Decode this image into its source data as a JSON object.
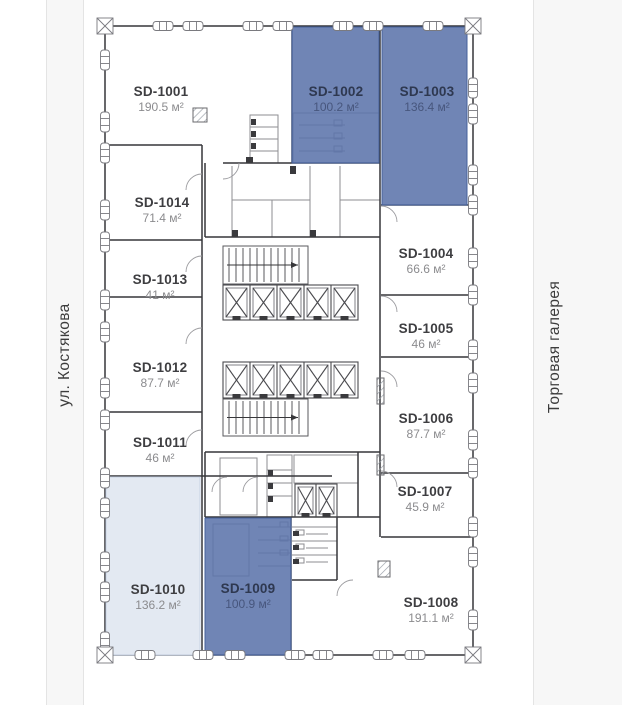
{
  "side_labels": {
    "left": "ул. Костякова",
    "right": "Торговая галерея"
  },
  "units": [
    {
      "id": "SD-1001",
      "name": "SD-1001",
      "area": "190.5 м²",
      "highlight": "none"
    },
    {
      "id": "SD-1002",
      "name": "SD-1002",
      "area": "100.2 м²",
      "highlight": "blue"
    },
    {
      "id": "SD-1003",
      "name": "SD-1003",
      "area": "136.4 м²",
      "highlight": "blue"
    },
    {
      "id": "SD-1004",
      "name": "SD-1004",
      "area": "66.6 м²",
      "highlight": "none"
    },
    {
      "id": "SD-1005",
      "name": "SD-1005",
      "area": "46 м²",
      "highlight": "none"
    },
    {
      "id": "SD-1006",
      "name": "SD-1006",
      "area": "87.7 м²",
      "highlight": "none"
    },
    {
      "id": "SD-1007",
      "name": "SD-1007",
      "area": "45.9 м²",
      "highlight": "none"
    },
    {
      "id": "SD-1008",
      "name": "SD-1008",
      "area": "191.1 м²",
      "highlight": "none"
    },
    {
      "id": "SD-1009",
      "name": "SD-1009",
      "area": "100.9 м²",
      "highlight": "blue"
    },
    {
      "id": "SD-1010",
      "name": "SD-1010",
      "area": "136.2 м²",
      "highlight": "light"
    },
    {
      "id": "SD-1011",
      "name": "SD-1011",
      "area": "46 м²",
      "highlight": "none"
    },
    {
      "id": "SD-1012",
      "name": "SD-1012",
      "area": "87.7 м²",
      "highlight": "none"
    },
    {
      "id": "SD-1013",
      "name": "SD-1013",
      "area": "41 м²",
      "highlight": "none"
    },
    {
      "id": "SD-1014",
      "name": "SD-1014",
      "area": "71.4 м²",
      "highlight": "none"
    }
  ],
  "colors": {
    "highlight_blue": "#5c74ab",
    "highlight_blue_border": "#46619b",
    "highlight_light": "#e1e7f1",
    "highlight_light_border": "#c7d2e4",
    "strip_bg": "#f7f7f7"
  }
}
